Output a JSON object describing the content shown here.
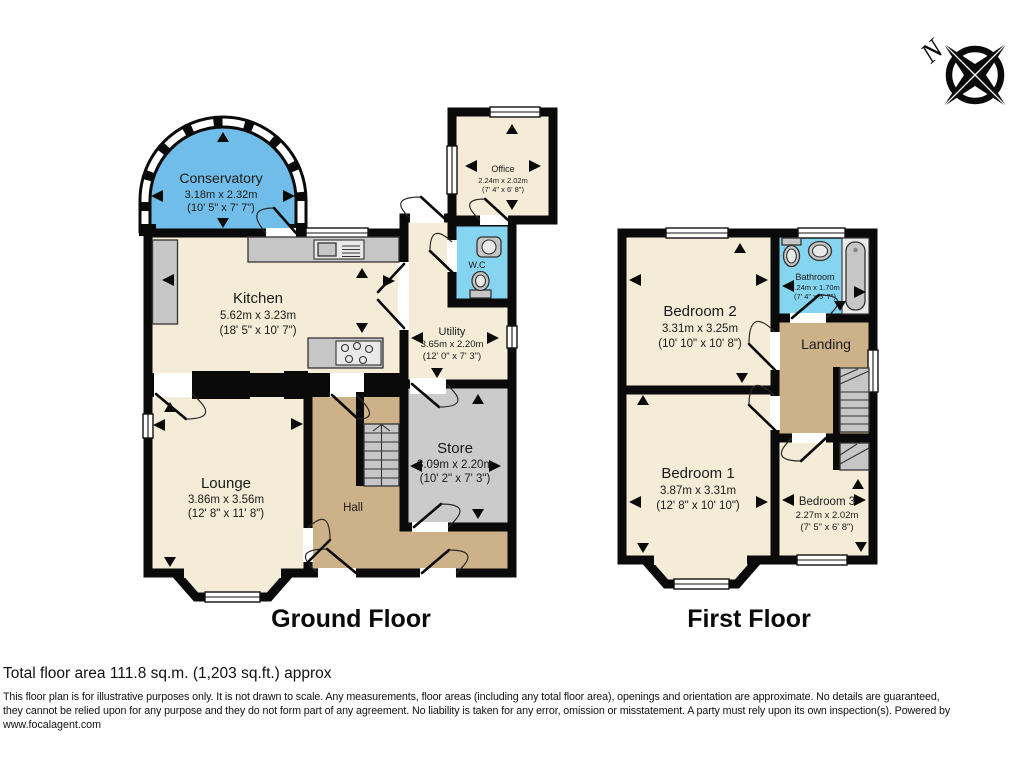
{
  "meta": {
    "compass_label": "N"
  },
  "colors": {
    "room_cream": "#F4ECD6",
    "room_blue": "#6FBDE8",
    "room_cyan": "#85D4F0",
    "room_tan": "#CDB189",
    "room_gray": "#CBCBCB",
    "wall": "#0A0A0A"
  },
  "floors": {
    "ground": {
      "label": "Ground Floor",
      "rooms": {
        "conservatory": {
          "name": "Conservatory",
          "metric": "3.18m x 2.32m",
          "imperial": "(10' 5\" x 7' 7\")"
        },
        "kitchen": {
          "name": "Kitchen",
          "metric": "5.62m x 3.23m",
          "imperial": "(18' 5\" x 10' 7\")"
        },
        "office": {
          "name": "Office",
          "metric": "2.24m x 2.02m",
          "imperial": "(7' 4\" x 6' 8\")"
        },
        "wc": {
          "name": "W.C"
        },
        "utility": {
          "name": "Utility",
          "metric": "3.65m x 2.20m",
          "imperial": "(12' 0\" x 7' 3\")"
        },
        "store": {
          "name": "Store",
          "metric": "3.09m x 2.20m",
          "imperial": "(10' 2\" x 7' 3\")"
        },
        "lounge": {
          "name": "Lounge",
          "metric": "3.86m x 3.56m",
          "imperial": "(12' 8\" x 11' 8\")"
        },
        "hall": {
          "name": "Hall"
        }
      }
    },
    "first": {
      "label": "First Floor",
      "rooms": {
        "bedroom2": {
          "name": "Bedroom 2",
          "metric": "3.31m x 3.25m",
          "imperial": "(10' 10\" x 10' 8\")"
        },
        "bathroom": {
          "name": "Bathroom",
          "metric": "2.24m x 1.70m",
          "imperial": "(7' 4\" x 5' 7\")"
        },
        "landing": {
          "name": "Landing"
        },
        "bedroom1": {
          "name": "Bedroom 1",
          "metric": "3.87m x 3.31m",
          "imperial": "(12' 8\" x 10' 10\")"
        },
        "bedroom3": {
          "name": "Bedroom 3",
          "metric": "2.27m x 2.02m",
          "imperial": "(7' 5\" x 6' 8\")"
        }
      }
    }
  },
  "footer": {
    "total_area": "Total floor area 111.8 sq.m. (1,203 sq.ft.) approx",
    "disclaimer_line1": "This floor plan is for illustrative purposes only. It is not drawn to scale. Any measurements, floor areas (including any total floor area), openings and orientation are approximate. No details are guaranteed,",
    "disclaimer_line2": "they cannot be relied upon for any purpose and they do not form part of any agreement. No liability is taken for any error, omission or misstatement. A party must rely upon its own inspection(s). Powered by",
    "website": "www.focalagent.com"
  }
}
